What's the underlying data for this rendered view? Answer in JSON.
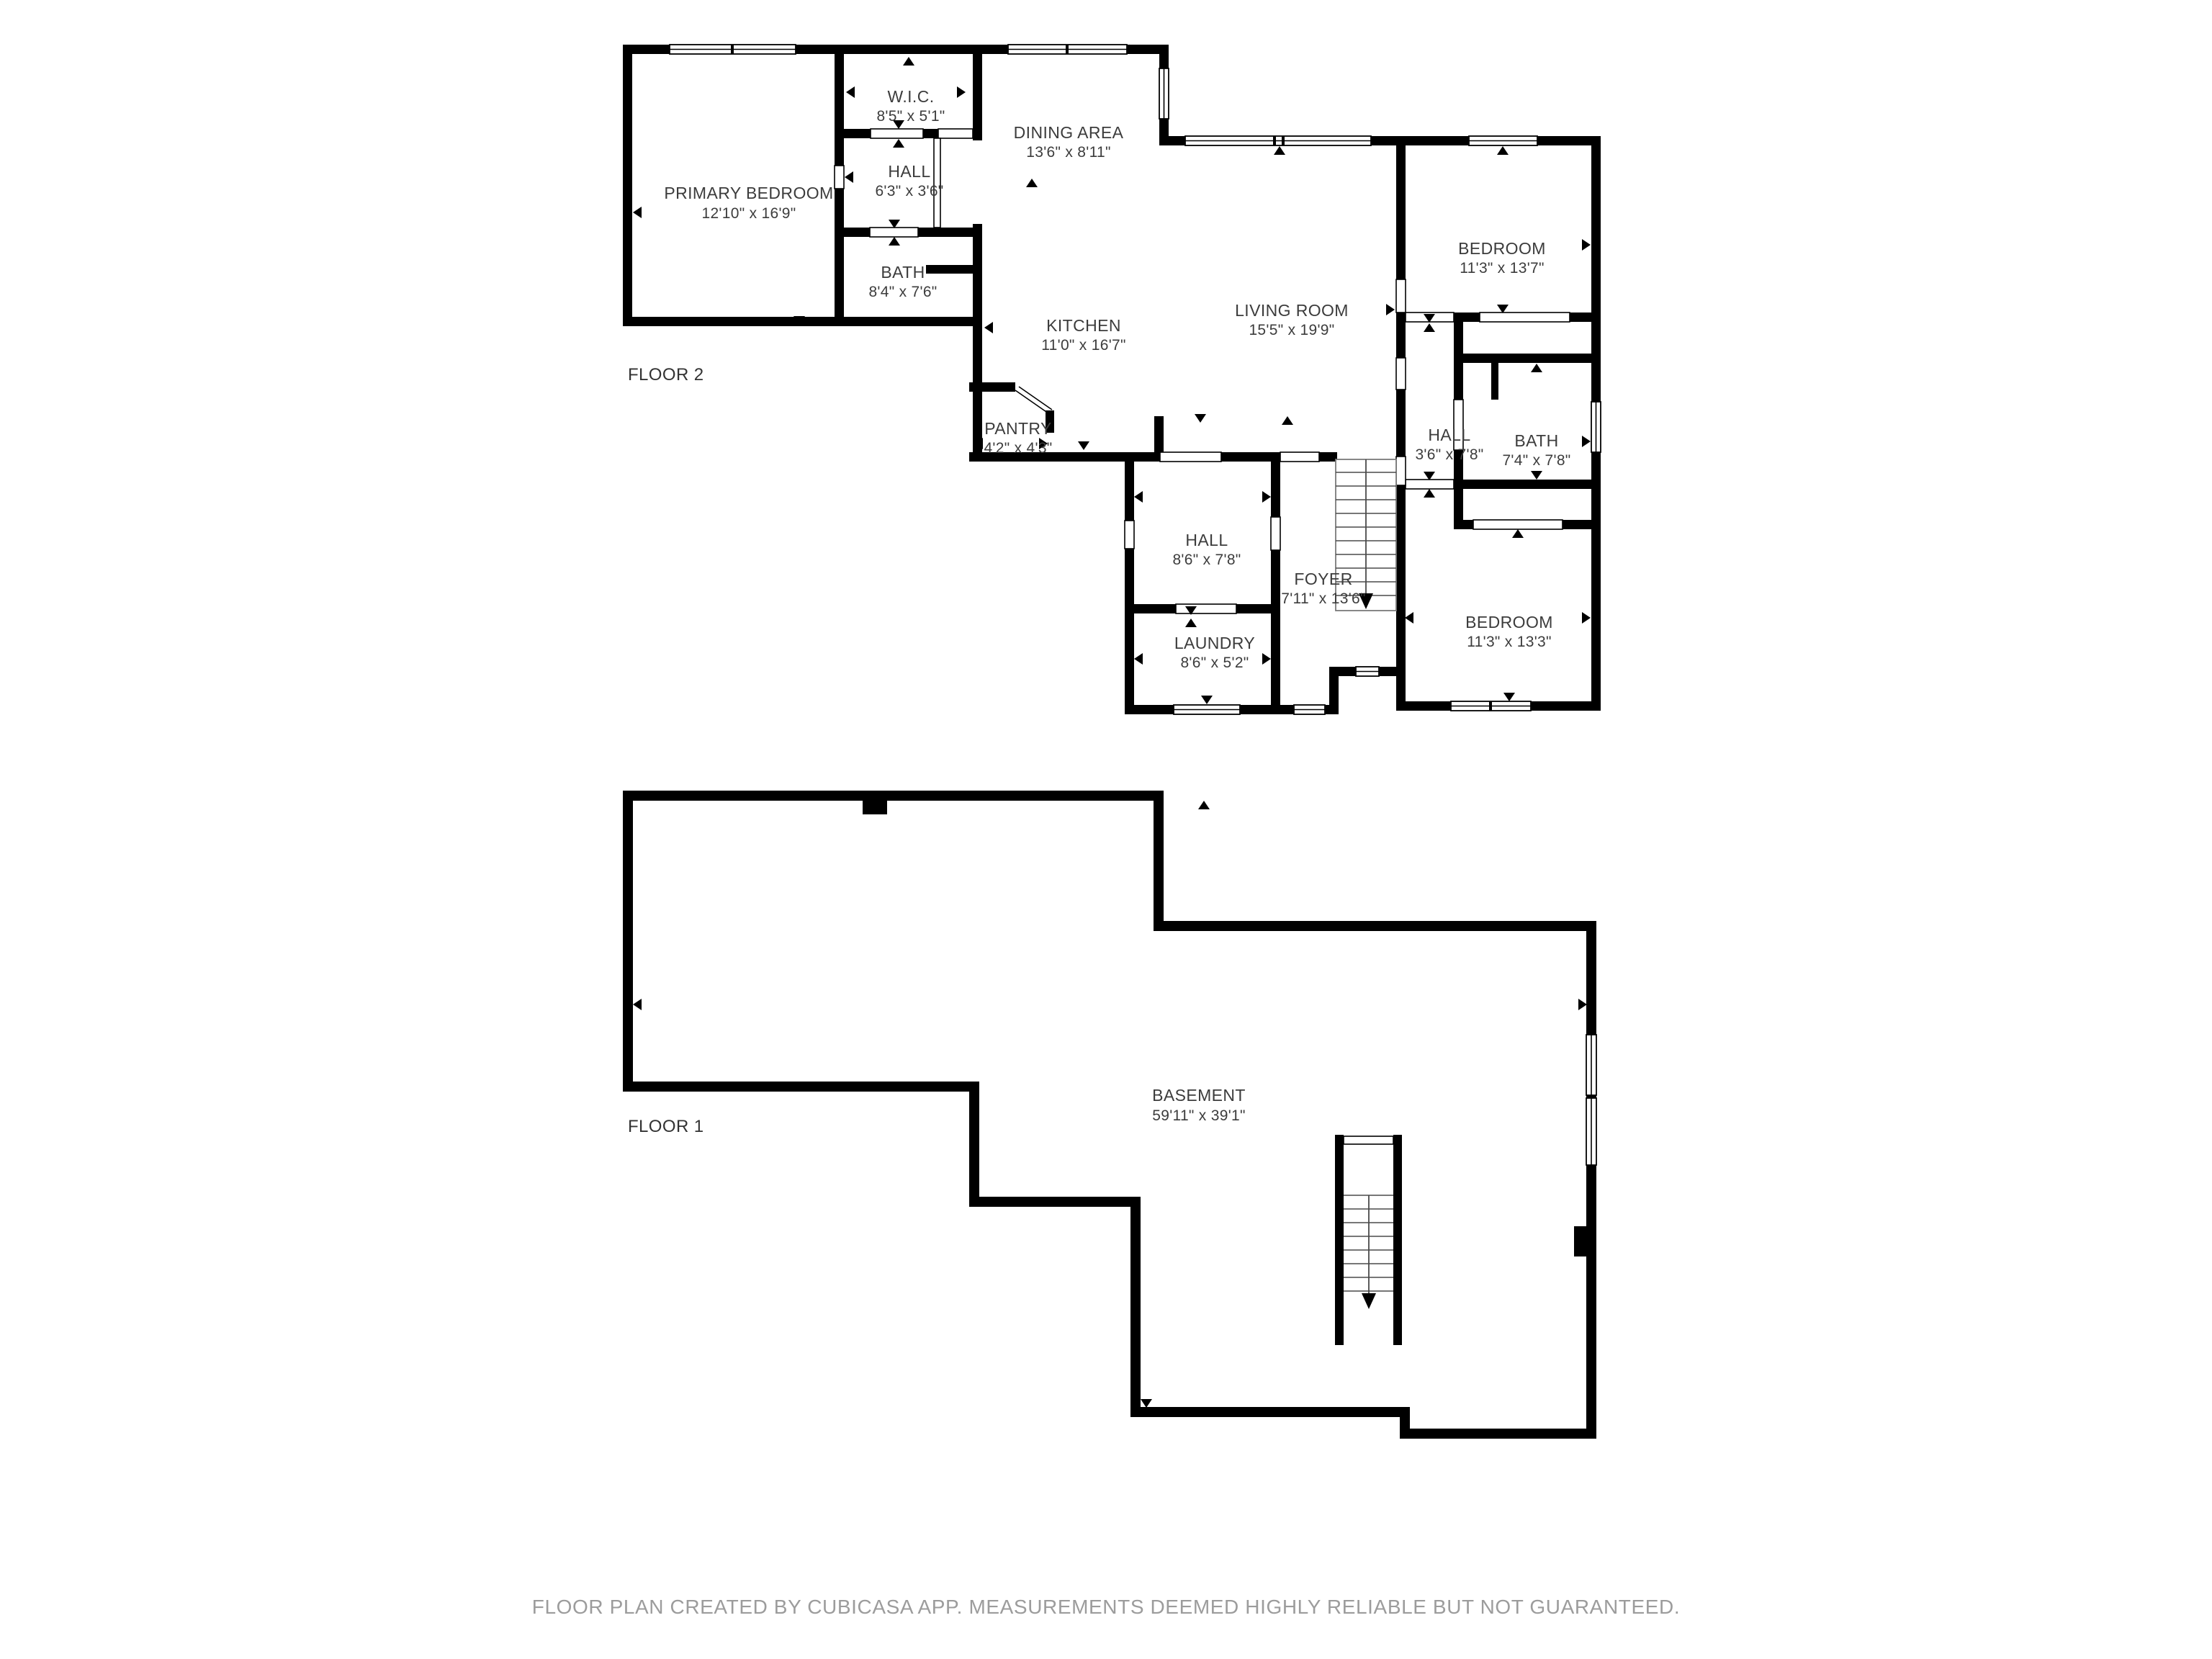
{
  "app": {
    "kind": "floor-plan-image",
    "creator_note": "FLOOR PLAN CREATED BY CUBICASA APP. MEASUREMENTS DEEMED HIGHLY RELIABLE BUT NOT GUARANTEED."
  },
  "colors": {
    "wall": "#000000",
    "background": "#ffffff",
    "label": "#3c3c3c",
    "footer": "#9c9c9c"
  },
  "floors": [
    {
      "title": "FLOOR 2",
      "rooms": [
        {
          "name": "PRIMARY BEDROOM",
          "dims": "12'10\" x 16'9\""
        },
        {
          "name": "W.I.C.",
          "dims": "8'5\" x 5'1\""
        },
        {
          "name": "HALL",
          "dims": "6'3\" x 3'6\""
        },
        {
          "name": "BATH",
          "dims": "8'4\" x 7'6\""
        },
        {
          "name": "DINING AREA",
          "dims": "13'6\" x 8'11\""
        },
        {
          "name": "KITCHEN",
          "dims": "11'0\" x 16'7\""
        },
        {
          "name": "LIVING ROOM",
          "dims": "15'5\" x 19'9\""
        },
        {
          "name": "BEDROOM",
          "dims": "11'3\" x 13'7\""
        },
        {
          "name": "HALL",
          "dims": "3'6\" x 7'8\""
        },
        {
          "name": "BATH",
          "dims": "7'4\" x 7'8\""
        },
        {
          "name": "PANTRY",
          "dims": "4'2\" x 4'3\""
        },
        {
          "name": "HALL",
          "dims": "8'6\" x 7'8\""
        },
        {
          "name": "FOYER",
          "dims": "7'11\" x 13'6\""
        },
        {
          "name": "LAUNDRY",
          "dims": "8'6\" x 5'2\""
        },
        {
          "name": "BEDROOM",
          "dims": "11'3\" x 13'3\""
        }
      ]
    },
    {
      "title": "FLOOR 1",
      "rooms": [
        {
          "name": "BASEMENT",
          "dims": "59'11\" x 39'1\""
        }
      ]
    }
  ],
  "footer": {
    "text": "FLOOR PLAN CREATED BY CUBICASA APP. MEASUREMENTS DEEMED HIGHLY RELIABLE BUT NOT GUARANTEED."
  }
}
